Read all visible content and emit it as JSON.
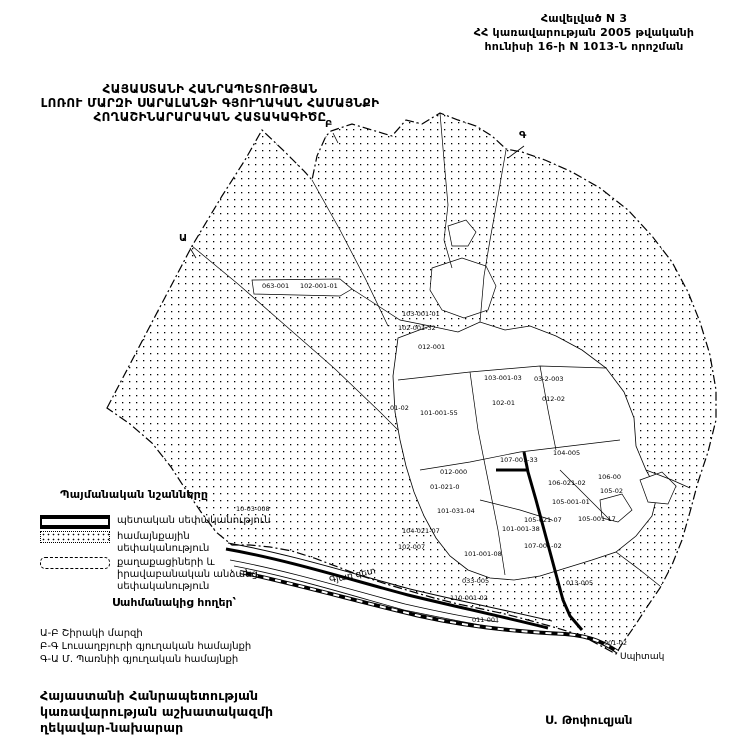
{
  "colors": {
    "ink": "#000000",
    "paper": "#ffffff"
  },
  "header": {
    "line1": "Հավելված N 3",
    "line2": "ՀՀ կառավարության 2005 թվականի",
    "line3": "հունիսի 16-ի N 1013-Ն որոշման"
  },
  "title": {
    "line1": "ՀԱՅԱՍՏԱՆԻ ՀԱՆՐԱՊԵՏՈՒԹՅԱՆ",
    "line2": "ԼՈՌՈՒ ՄԱՐԶԻ ՍԱՐԱԼԱՆՋԻ ԳՅՈՒՂԱԿԱՆ ՀԱՄԱՅՆՔԻ",
    "line3": "ՀՈՂԱՇԻՆԱՐԱՐԱԿԱՆ ՀԱՏԱԿԱԳԻԾԸ"
  },
  "legend": {
    "heading": "Պայմանական նշանները",
    "items": [
      {
        "swatch": "state",
        "label": "պետական սեփականություն"
      },
      {
        "swatch": "community",
        "label": "համայնքային սեփականություն"
      },
      {
        "swatch": "private",
        "label": "քաղաքացիների և իրավաբանական անձանց սեփականություն"
      }
    ]
  },
  "borders": {
    "heading": "Սահմանակից հողեր՝",
    "items": [
      "Ա-Բ Շիրակի մարզի",
      "Բ-Գ Լուսաղբյուրի գյուղական համայնքի",
      "Գ-Ա Մ. Պառնիի գյուղական համայնքի"
    ]
  },
  "footer": {
    "line1": "Հայաստանի Հանրապետության",
    "line2": "կառավարության աշխատակազմի",
    "line3": "ղեկավար-նախարար",
    "signature": "Ս. Թոփուզյան"
  },
  "map": {
    "boundary_letters": [
      {
        "t": "Ա",
        "x": 179,
        "y": 241
      },
      {
        "t": "Բ",
        "x": 325,
        "y": 127
      },
      {
        "t": "Գ",
        "x": 519,
        "y": 138
      }
    ],
    "parcel_labels": [
      {
        "t": "063-001",
        "x": 262,
        "y": 288
      },
      {
        "t": "102-001-01",
        "x": 300,
        "y": 288
      },
      {
        "t": "103-001-01",
        "x": 402,
        "y": 316
      },
      {
        "t": "102-001-32",
        "x": 398,
        "y": 330
      },
      {
        "t": "012-001",
        "x": 418,
        "y": 349
      },
      {
        "t": "103-001-03",
        "x": 484,
        "y": 380
      },
      {
        "t": "03-2-003",
        "x": 534,
        "y": 381
      },
      {
        "t": "102-01",
        "x": 492,
        "y": 405
      },
      {
        "t": "012-02",
        "x": 542,
        "y": 401
      },
      {
        "t": "101-001-55",
        "x": 420,
        "y": 415
      },
      {
        "t": "01-02",
        "x": 390,
        "y": 410
      },
      {
        "t": "104-005",
        "x": 553,
        "y": 455
      },
      {
        "t": "107-001-33",
        "x": 500,
        "y": 462
      },
      {
        "t": "012-000",
        "x": 440,
        "y": 474
      },
      {
        "t": "01-021-0",
        "x": 430,
        "y": 489
      },
      {
        "t": "106-021-02",
        "x": 548,
        "y": 485
      },
      {
        "t": "106-00",
        "x": 598,
        "y": 479
      },
      {
        "t": "105-02",
        "x": 600,
        "y": 493
      },
      {
        "t": "105-001-01",
        "x": 552,
        "y": 504
      },
      {
        "t": "105-001-17",
        "x": 578,
        "y": 521
      },
      {
        "t": "101-031-04",
        "x": 437,
        "y": 513
      },
      {
        "t": "105-021-07",
        "x": 524,
        "y": 522
      },
      {
        "t": "101-001-38",
        "x": 502,
        "y": 531
      },
      {
        "t": "104-021-07",
        "x": 402,
        "y": 533
      },
      {
        "t": "102-007",
        "x": 398,
        "y": 549
      },
      {
        "t": "107-001-02",
        "x": 524,
        "y": 548
      },
      {
        "t": "101-001-08",
        "x": 464,
        "y": 556
      },
      {
        "t": "033-005",
        "x": 462,
        "y": 583
      },
      {
        "t": "013-005",
        "x": 566,
        "y": 585
      },
      {
        "t": "110-001-02",
        "x": 450,
        "y": 600
      },
      {
        "t": "011-001",
        "x": 472,
        "y": 622
      },
      {
        "t": "10-03-008",
        "x": 236,
        "y": 511
      },
      {
        "t": "001-02",
        "x": 604,
        "y": 645
      }
    ],
    "place_labels": [
      {
        "t": "Գյառ գետ",
        "x": 330,
        "y": 583,
        "rotate": -12
      },
      {
        "t": "Սպիտակ",
        "x": 620,
        "y": 659
      }
    ]
  }
}
